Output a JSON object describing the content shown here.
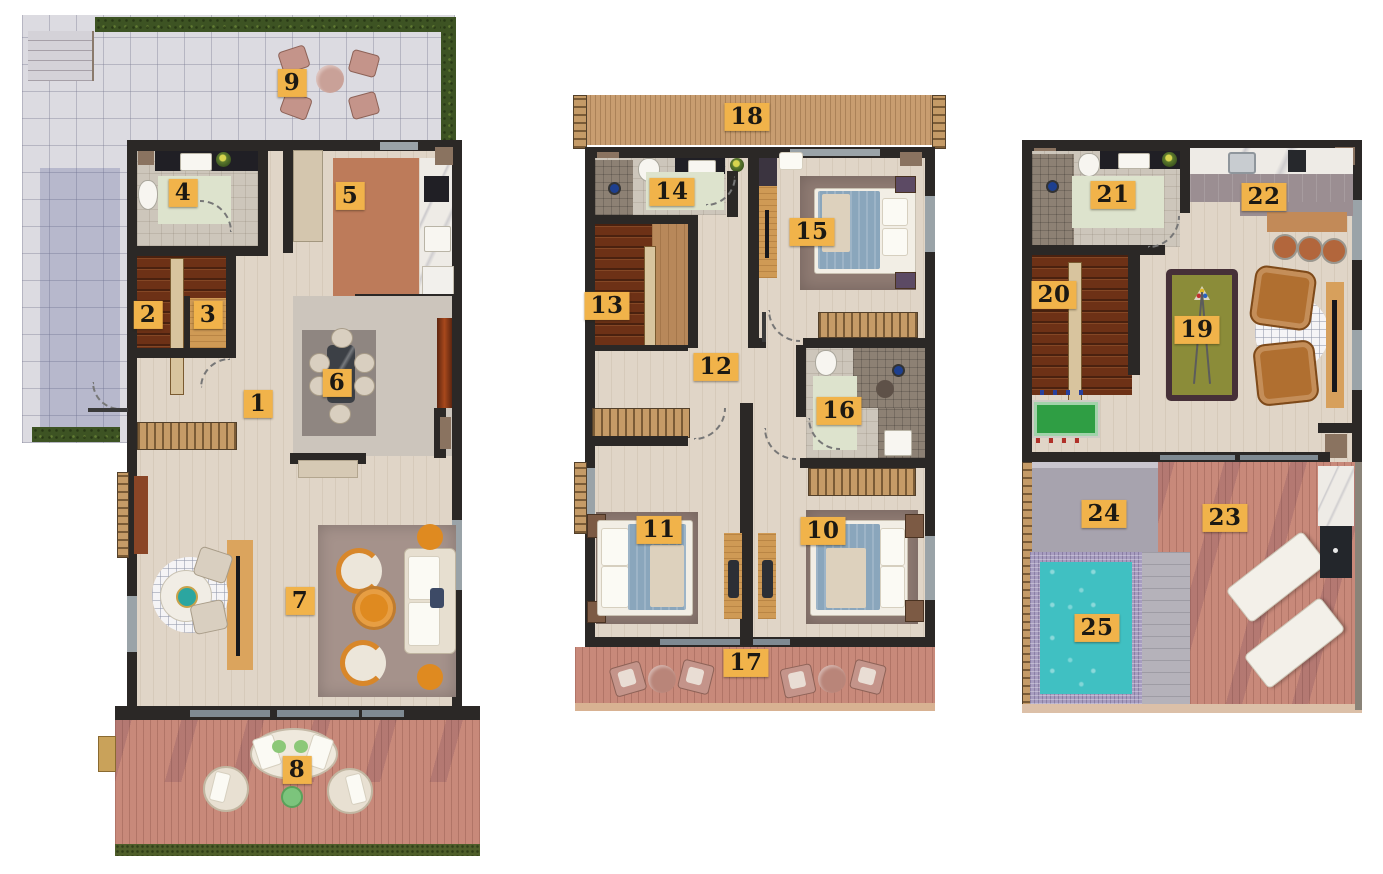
{
  "canvas": {
    "width": 1383,
    "height": 874
  },
  "colors": {
    "marker_bg": "#f1b34a",
    "marker_text": "#1c1913",
    "wall": "#2b2826",
    "wood_floor": "#e0d5c7",
    "deck_wood": "#c8897a",
    "balcony_slats": "#c89d70",
    "pool_water": "#40c0c2",
    "pool_mosaic": "#a79dc0",
    "hedge_green": "#3d5323",
    "billiard_felt": "#8b8c39",
    "armchair_leather": "#b06f30",
    "pergola_grey": "#a7a3ae",
    "stairs_wood": "#6d3116",
    "terrace_paver": "#dcdbe1"
  },
  "markers": [
    {
      "label": "1",
      "x": 258,
      "y": 404
    },
    {
      "label": "2",
      "x": 148,
      "y": 315
    },
    {
      "label": "3",
      "x": 208,
      "y": 315
    },
    {
      "label": "4",
      "x": 183,
      "y": 193
    },
    {
      "label": "5",
      "x": 350,
      "y": 196
    },
    {
      "label": "6",
      "x": 337,
      "y": 383
    },
    {
      "label": "7",
      "x": 300,
      "y": 601
    },
    {
      "label": "8",
      "x": 297,
      "y": 770
    },
    {
      "label": "9",
      "x": 292,
      "y": 83
    },
    {
      "label": "10",
      "x": 823,
      "y": 531
    },
    {
      "label": "11",
      "x": 659,
      "y": 530
    },
    {
      "label": "12",
      "x": 716,
      "y": 367
    },
    {
      "label": "13",
      "x": 607,
      "y": 306
    },
    {
      "label": "14",
      "x": 672,
      "y": 192
    },
    {
      "label": "15",
      "x": 812,
      "y": 232
    },
    {
      "label": "16",
      "x": 839,
      "y": 411
    },
    {
      "label": "17",
      "x": 746,
      "y": 663
    },
    {
      "label": "18",
      "x": 747,
      "y": 117
    },
    {
      "label": "19",
      "x": 1197,
      "y": 330
    },
    {
      "label": "20",
      "x": 1054,
      "y": 295
    },
    {
      "label": "21",
      "x": 1113,
      "y": 195
    },
    {
      "label": "22",
      "x": 1264,
      "y": 197
    },
    {
      "label": "23",
      "x": 1225,
      "y": 518
    },
    {
      "label": "24",
      "x": 1104,
      "y": 514
    },
    {
      "label": "25",
      "x": 1097,
      "y": 628
    }
  ]
}
